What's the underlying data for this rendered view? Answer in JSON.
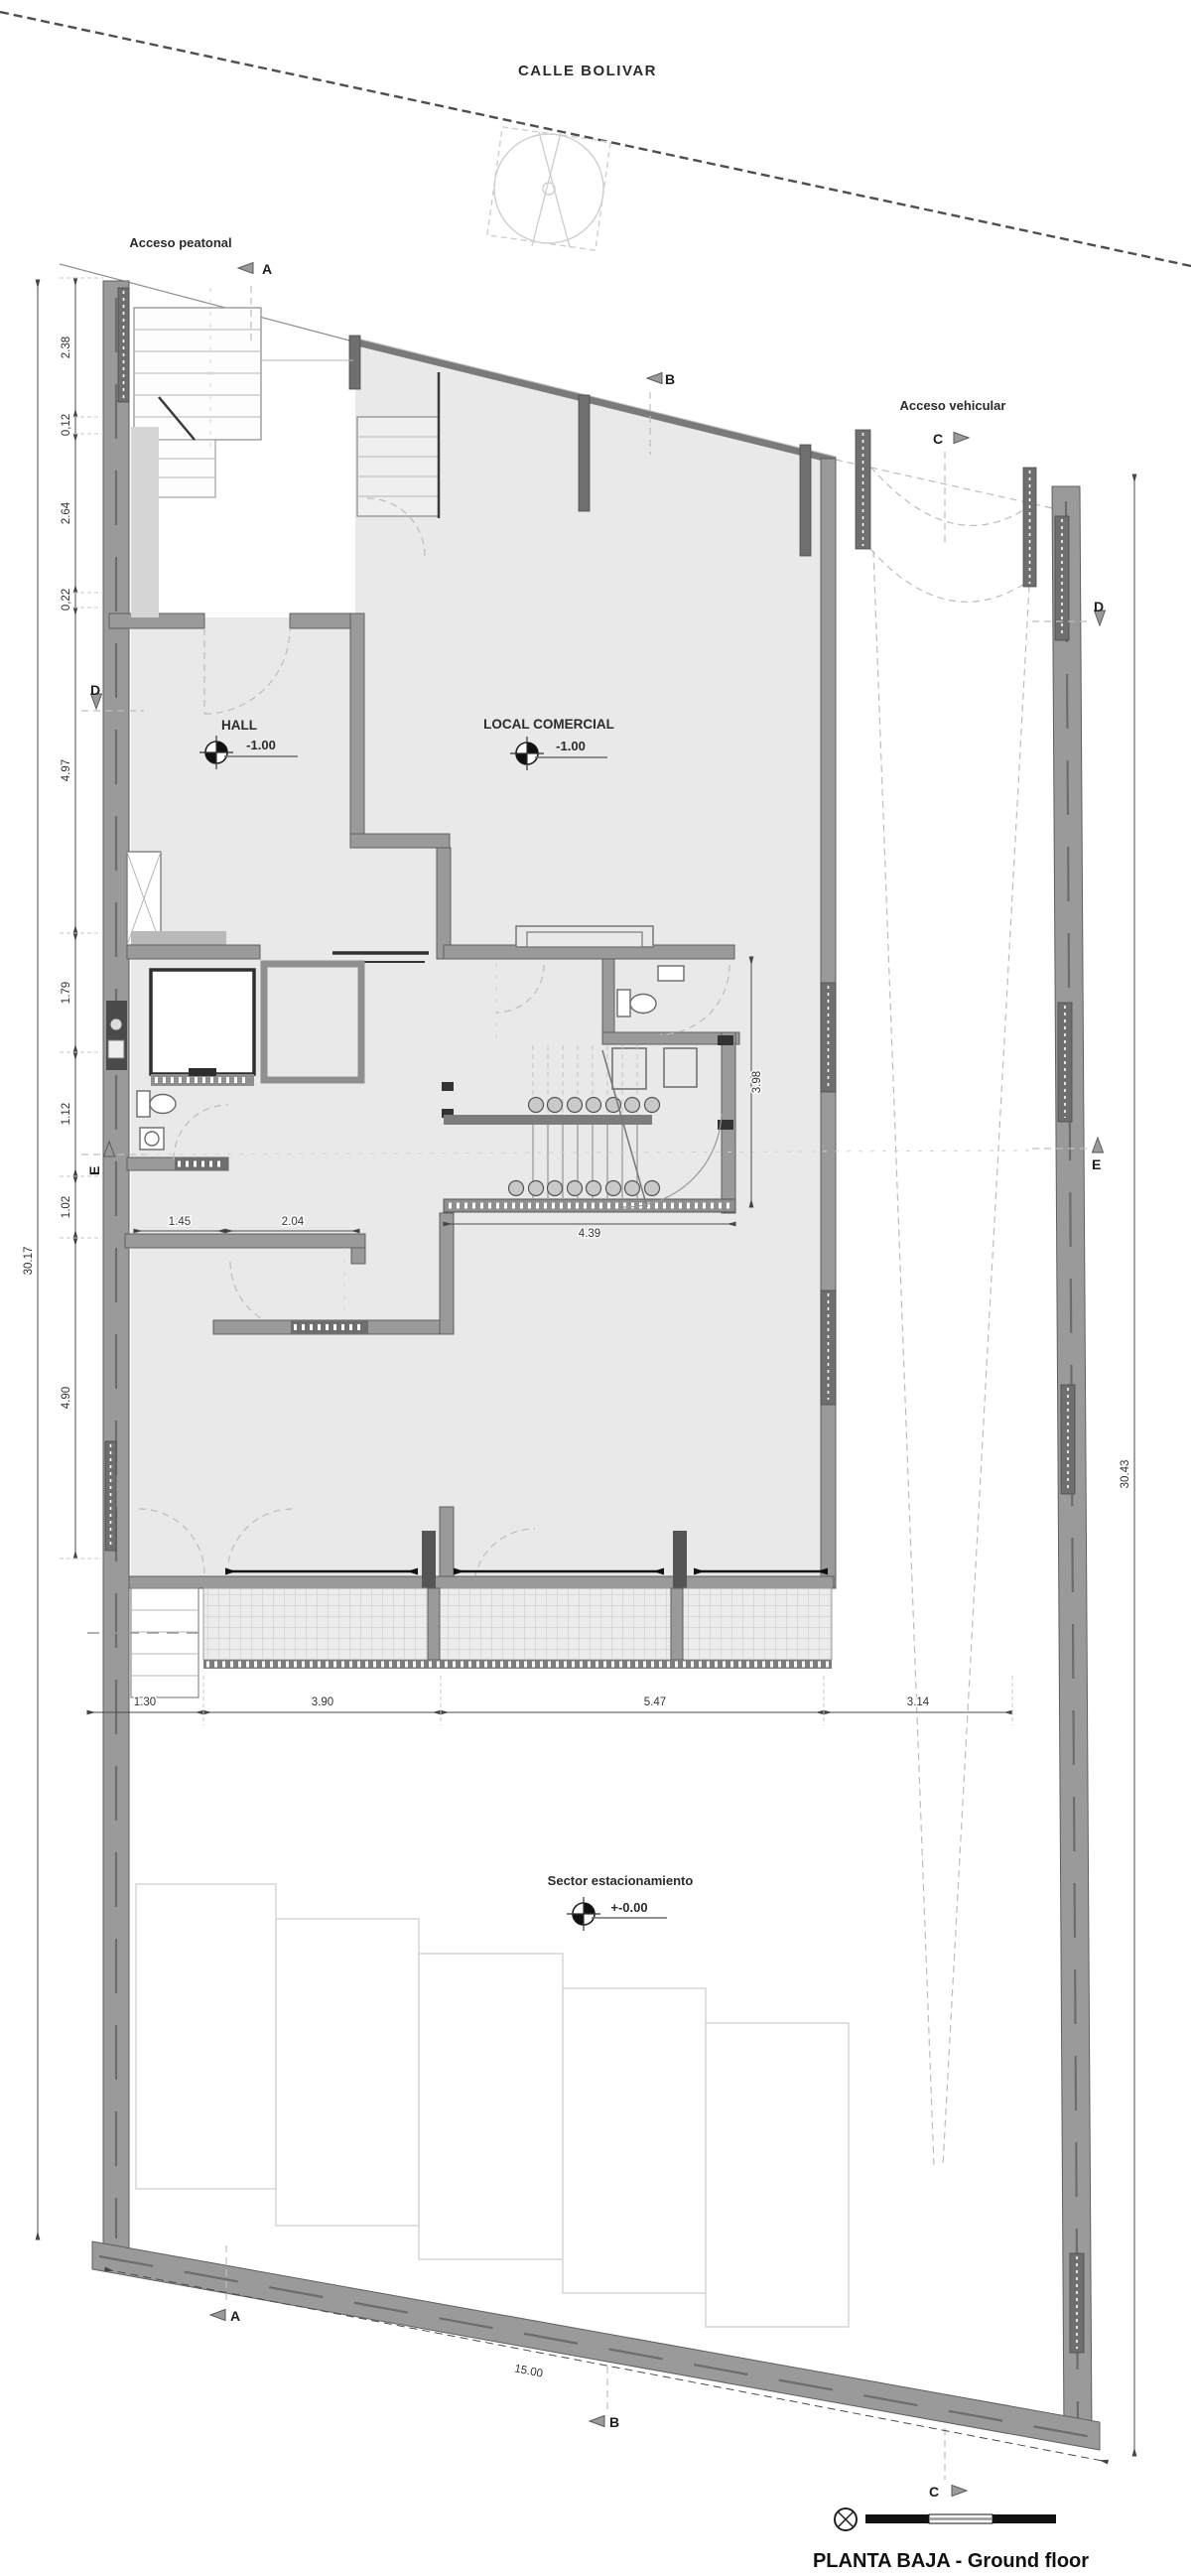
{
  "street": {
    "name": "CALLE BOLIVAR"
  },
  "access": {
    "pedestrian": "Acceso peatonal",
    "vehicular": "Acceso vehicular"
  },
  "rooms": {
    "hall": {
      "name": "HALL",
      "level": "-1.00"
    },
    "local": {
      "name": "LOCAL COMERCIAL",
      "level": "-1.00"
    },
    "parking": {
      "name": "Sector estacionamiento",
      "level": "+-0.00"
    }
  },
  "markers": {
    "a": "A",
    "b": "B",
    "c": "C",
    "d": "D",
    "e": "E"
  },
  "dimensions": {
    "left_chain": [
      "2.38",
      "0,12",
      "2.64",
      "0,22",
      "4.97",
      "1.79",
      "1.12",
      "1.02",
      "4.90"
    ],
    "left_total": "30.17",
    "right_total": "30.43",
    "bottom_chain": [
      "1.30",
      "3.90",
      "5.47",
      "3.14"
    ],
    "front_total": "15.00",
    "stair_width": "4.39",
    "stair_depth": "3.98",
    "room_widths": [
      "1.45",
      "2.04"
    ]
  },
  "title": "PLANTA BAJA - Ground floor",
  "colors": {
    "wall": "#9a9a9a",
    "wall_edge": "#5f5f5f",
    "floor": "#e9e9e9",
    "dim_text": "#333333"
  }
}
